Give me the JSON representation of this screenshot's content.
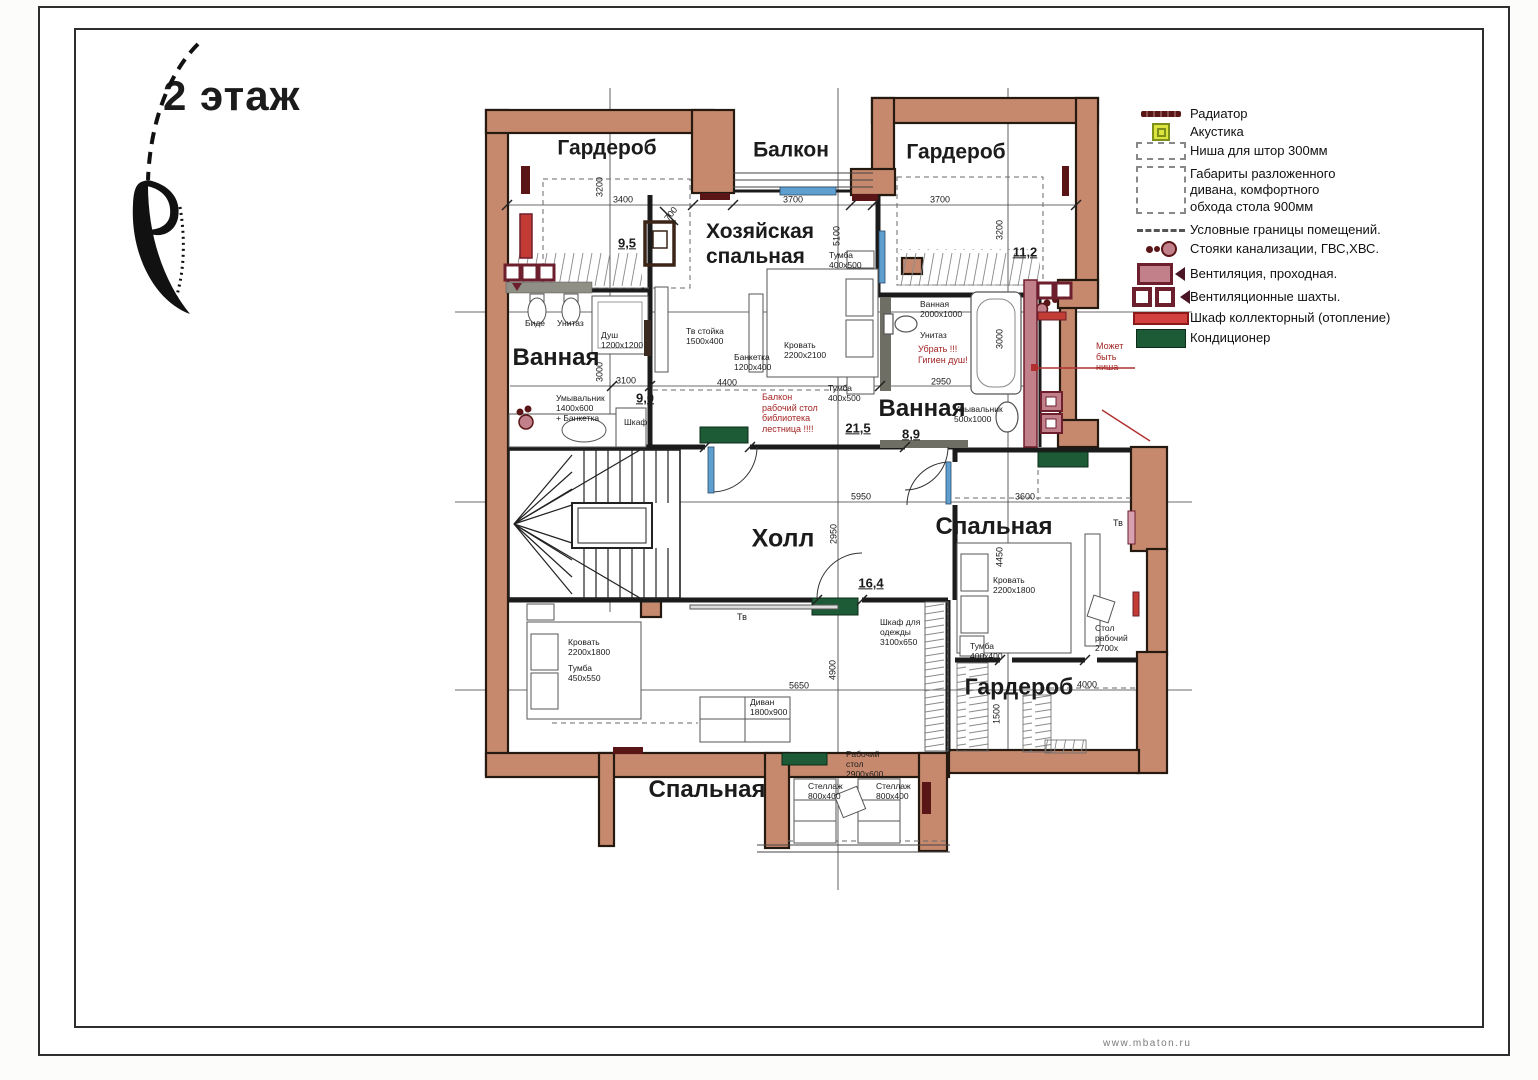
{
  "title": "2 этаж",
  "watermark": "www.mbaton.ru",
  "legend": {
    "items": [
      {
        "icon": "radiator-icon",
        "label": "Радиатор"
      },
      {
        "icon": "acoustics-icon",
        "label": "Акустика"
      },
      {
        "icon": "curtain-niche-icon",
        "label": "Ниша для штор 300мм"
      },
      {
        "icon": "sofa-clearance-icon",
        "label": "Габариты разложенного\nдивана, комфортного\nобхода стола 900мм"
      },
      {
        "icon": "room-boundary-icon",
        "label": "Условные границы помещений."
      },
      {
        "icon": "risers-icon",
        "label": "Стояки канализации, ГВС,ХВС."
      },
      {
        "icon": "vent-through-icon",
        "label": "Вентиляция, проходная."
      },
      {
        "icon": "vent-shaft-icon",
        "label": "Вентиляционные шахты."
      },
      {
        "icon": "collector-cabinet-icon",
        "label": "Шкаф коллекторный (отопление)"
      },
      {
        "icon": "conditioner-icon",
        "label": "Кондиционер"
      }
    ]
  },
  "rooms": [
    {
      "name": "Гардероб",
      "area": "9,5"
    },
    {
      "name": "Балкон",
      "area": ""
    },
    {
      "name": "Гардероб",
      "area": "11,2"
    },
    {
      "name": "Хозяйская спальная",
      "area": "21,5"
    },
    {
      "name": "Ванная",
      "area": "9,0"
    },
    {
      "name": "Ванная",
      "area": "8,9"
    },
    {
      "name": "Холл",
      "area": "16,4"
    },
    {
      "name": "Спальная",
      "area": ""
    },
    {
      "name": "Гардероб",
      "area": ""
    },
    {
      "name": "Спальная",
      "area": ""
    }
  ],
  "plan_labels": [
    {
      "n": "room-garderob-tl",
      "t": "Гардероб",
      "x": 607,
      "y": 149,
      "fs": 21,
      "fw": 700,
      "anc": "c"
    },
    {
      "n": "room-balkon",
      "t": "Балкон",
      "x": 791,
      "y": 151,
      "fs": 21,
      "fw": 700,
      "anc": "c"
    },
    {
      "n": "room-garderob-tr",
      "t": "Гардероб",
      "x": 956,
      "y": 153,
      "fs": 21,
      "fw": 700,
      "anc": "c"
    },
    {
      "n": "room-master",
      "t": "Хозяйская\nспальная",
      "x": 706,
      "y": 220,
      "fs": 21,
      "fw": 700
    },
    {
      "n": "room-bath-left",
      "t": "Ванная",
      "x": 556,
      "y": 358,
      "fs": 24,
      "fw": 700,
      "anc": "c"
    },
    {
      "n": "room-bath-right",
      "t": "Ванная",
      "x": 922,
      "y": 409,
      "fs": 24,
      "fw": 700,
      "anc": "c"
    },
    {
      "n": "room-hall",
      "t": "Холл",
      "x": 783,
      "y": 539,
      "fs": 25,
      "fw": 700,
      "anc": "c"
    },
    {
      "n": "room-bedroom-right",
      "t": "Спальная",
      "x": 994,
      "y": 527,
      "fs": 24,
      "fw": 700,
      "anc": "c"
    },
    {
      "n": "room-garderob-br",
      "t": "Гардероб",
      "x": 1019,
      "y": 687,
      "fs": 23,
      "fw": 700,
      "anc": "c"
    },
    {
      "n": "room-bedroom-bottom",
      "t": "Спальная",
      "x": 707,
      "y": 790,
      "fs": 24,
      "fw": 700,
      "anc": "c"
    },
    {
      "n": "area-value",
      "t": "9,5",
      "x": 627,
      "y": 243,
      "fs": 13,
      "fw": 700,
      "u": true,
      "anc": "c"
    },
    {
      "n": "area-value",
      "t": "11,2",
      "x": 1025,
      "y": 252,
      "fs": 13,
      "fw": 700,
      "u": true,
      "anc": "c"
    },
    {
      "n": "area-value",
      "t": "9,0",
      "x": 645,
      "y": 398,
      "fs": 13,
      "fw": 700,
      "u": true,
      "anc": "c"
    },
    {
      "n": "area-value",
      "t": "21,5",
      "x": 858,
      "y": 428,
      "fs": 13,
      "fw": 700,
      "u": true,
      "anc": "c"
    },
    {
      "n": "area-value",
      "t": "8,9",
      "x": 911,
      "y": 434,
      "fs": 13,
      "fw": 700,
      "u": true,
      "anc": "c"
    },
    {
      "n": "area-value",
      "t": "16,4",
      "x": 871,
      "y": 583,
      "fs": 13,
      "fw": 700,
      "u": true,
      "anc": "c"
    },
    {
      "n": "dim",
      "t": "3200",
      "x": 600,
      "y": 187,
      "fs": 9,
      "r": -90,
      "anc": "c"
    },
    {
      "n": "dim",
      "t": "3400",
      "x": 623,
      "y": 200,
      "fs": 9,
      "anc": "c"
    },
    {
      "n": "dim",
      "t": "700",
      "x": 671,
      "y": 214,
      "fs": 9,
      "r": -52,
      "anc": "c"
    },
    {
      "n": "dim",
      "t": "3700",
      "x": 793,
      "y": 200,
      "fs": 9,
      "anc": "c"
    },
    {
      "n": "dim",
      "t": "3700",
      "x": 940,
      "y": 200,
      "fs": 9,
      "anc": "c"
    },
    {
      "n": "dim",
      "t": "3200",
      "x": 1000,
      "y": 230,
      "fs": 9,
      "r": -90,
      "anc": "c"
    },
    {
      "n": "dim",
      "t": "5100",
      "x": 837,
      "y": 236,
      "fs": 9,
      "r": -90,
      "anc": "c"
    },
    {
      "n": "dim",
      "t": "3000",
      "x": 600,
      "y": 372,
      "fs": 9,
      "r": -90,
      "anc": "c"
    },
    {
      "n": "dim",
      "t": "3100",
      "x": 626,
      "y": 381,
      "fs": 9,
      "anc": "c"
    },
    {
      "n": "dim",
      "t": "4400",
      "x": 727,
      "y": 383,
      "fs": 9,
      "anc": "c"
    },
    {
      "n": "dim",
      "t": "2950",
      "x": 941,
      "y": 382,
      "fs": 9,
      "anc": "c"
    },
    {
      "n": "dim",
      "t": "3000",
      "x": 1000,
      "y": 339,
      "fs": 9,
      "r": -90,
      "anc": "c"
    },
    {
      "n": "dim",
      "t": "5950",
      "x": 861,
      "y": 497,
      "fs": 9,
      "anc": "c"
    },
    {
      "n": "dim",
      "t": "3600",
      "x": 1025,
      "y": 497,
      "fs": 9,
      "anc": "c"
    },
    {
      "n": "dim",
      "t": "2950",
      "x": 834,
      "y": 534,
      "fs": 9,
      "r": -90,
      "anc": "c"
    },
    {
      "n": "dim",
      "t": "4450",
      "x": 1000,
      "y": 557,
      "fs": 9,
      "r": -90,
      "anc": "c"
    },
    {
      "n": "dim",
      "t": "5650",
      "x": 799,
      "y": 686,
      "fs": 9,
      "anc": "c"
    },
    {
      "n": "dim",
      "t": "4900",
      "x": 833,
      "y": 670,
      "fs": 9,
      "r": -90,
      "anc": "c"
    },
    {
      "n": "dim",
      "t": "1500",
      "x": 997,
      "y": 714,
      "fs": 9,
      "r": -90,
      "anc": "c"
    },
    {
      "n": "dim",
      "t": "4000",
      "x": 1087,
      "y": 685,
      "fs": 9,
      "anc": "c"
    },
    {
      "n": "furniture-label",
      "t": "Биде",
      "x": 525,
      "y": 318
    },
    {
      "n": "furniture-label",
      "t": "Унитаз",
      "x": 557,
      "y": 318
    },
    {
      "n": "furniture-label",
      "t": "Душ\n1200х1200",
      "x": 601,
      "y": 330
    },
    {
      "n": "furniture-label",
      "t": "Тв стойка\n1500х400",
      "x": 686,
      "y": 326
    },
    {
      "n": "furniture-label",
      "t": "Кровать\n2200х2100",
      "x": 784,
      "y": 340
    },
    {
      "n": "furniture-label",
      "t": "Банкетка\n1200х400",
      "x": 734,
      "y": 352
    },
    {
      "n": "furniture-label",
      "t": "Тумба\n400х500",
      "x": 829,
      "y": 250
    },
    {
      "n": "furniture-label",
      "t": "Тумба\n400х500",
      "x": 828,
      "y": 383
    },
    {
      "n": "furniture-label",
      "t": "Ванная\n2000х1000",
      "x": 920,
      "y": 299
    },
    {
      "n": "furniture-label",
      "t": "Унитаз",
      "x": 920,
      "y": 330
    },
    {
      "n": "furniture-label",
      "t": "Умывальник\n1400х600\n+ Банкетка",
      "x": 556,
      "y": 393
    },
    {
      "n": "furniture-label",
      "t": "Шкаф",
      "x": 624,
      "y": 417
    },
    {
      "n": "furniture-label",
      "t": "Умывальник\n500х1000",
      "x": 954,
      "y": 404
    },
    {
      "n": "furniture-label",
      "t": "Тв",
      "x": 737,
      "y": 612,
      "fs": 9
    },
    {
      "n": "furniture-label",
      "t": "Шкаф для\nодежды\n3100х650",
      "x": 880,
      "y": 617
    },
    {
      "n": "furniture-label",
      "t": "Кровать\n2200х1800",
      "x": 568,
      "y": 637
    },
    {
      "n": "furniture-label",
      "t": "Тумба\n450х550",
      "x": 568,
      "y": 663
    },
    {
      "n": "furniture-label",
      "t": "Диван\n1800х900",
      "x": 750,
      "y": 697
    },
    {
      "n": "furniture-label",
      "t": "Кровать\n2200х1800",
      "x": 993,
      "y": 575
    },
    {
      "n": "furniture-label",
      "t": "Тумба\n400х400",
      "x": 970,
      "y": 641
    },
    {
      "n": "furniture-label",
      "t": "Стол\nрабочий\n2700х",
      "x": 1095,
      "y": 623
    },
    {
      "n": "furniture-label",
      "t": "Тв",
      "x": 1113,
      "y": 518,
      "fs": 9
    },
    {
      "n": "furniture-label",
      "t": "Рабочий\nстол\n2900х600",
      "x": 846,
      "y": 749
    },
    {
      "n": "furniture-label",
      "t": "Стеллаж\n800х400",
      "x": 808,
      "y": 781
    },
    {
      "n": "furniture-label",
      "t": "Стеллаж\n800х400",
      "x": 876,
      "y": 781
    },
    {
      "n": "note-red",
      "t": "Убрать !!!\nГигиен душ!",
      "x": 918,
      "y": 344,
      "fs": 9,
      "c": "#a32424"
    },
    {
      "n": "note-red",
      "t": "Может\nбыть\nниша",
      "x": 1096,
      "y": 341,
      "fs": 9,
      "c": "#a32424"
    },
    {
      "n": "note-red",
      "t": "Балкон\nрабочий стол\nбиблиотека\nлестница !!!!",
      "x": 762,
      "y": 392,
      "fs": 9,
      "c": "#a32424"
    }
  ]
}
